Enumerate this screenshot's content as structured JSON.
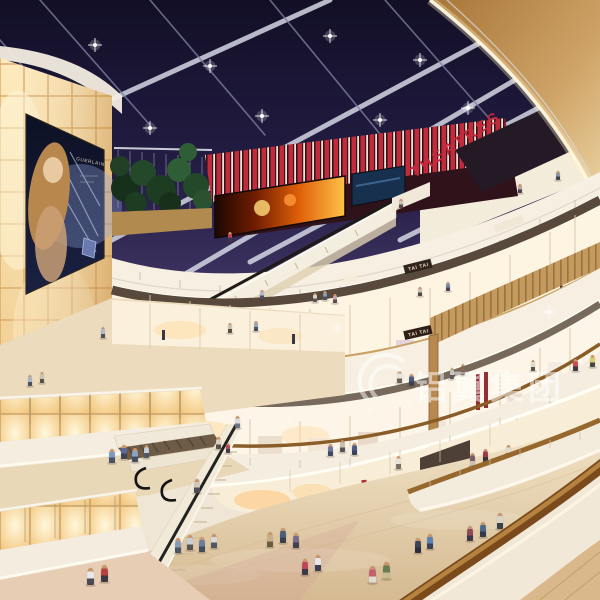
{
  "meta": {
    "title": "Shopping mall atrium interior rendering at night"
  },
  "signs": {
    "theatres": "THEATRES",
    "tai_tai_upper": "TAI TAI",
    "tai_tai_mid": "TAI TAI",
    "ad_brand": "GUERLAIN"
  },
  "watermark": {
    "text": "铝翼集团"
  },
  "palette": {
    "sky": "#1b1733",
    "accent_red": "#c2293a",
    "glow_wall": "#f8dca6",
    "wood": "#c49a5e",
    "fascia": "#f6efe2",
    "floor": "#e7d5b4"
  },
  "figures": [
    [
      315,
      302,
      9,
      "#d8d4ca",
      "#5a5a60",
      1
    ],
    [
      325,
      300,
      9,
      "#8a9ab5",
      "#485066",
      1
    ],
    [
      335,
      303,
      9,
      "#c9a4a8",
      "#564c50",
      1
    ],
    [
      262,
      299,
      9,
      "#b5bcc9",
      "#4c5260",
      1
    ],
    [
      420,
      296,
      9,
      "#c9c4b5",
      "#50484a",
      1
    ],
    [
      448,
      291,
      9,
      "#7a8aa8",
      "#42485a",
      1
    ],
    [
      401,
      208,
      9,
      "#c9c4ba",
      "#50484a",
      1
    ],
    [
      520,
      193,
      9,
      "#b5a8a0",
      "#46424a",
      1
    ],
    [
      558,
      180,
      9,
      "#8a95ad",
      "#3f4550",
      1
    ],
    [
      230,
      241,
      9,
      "#c0485a",
      "#3c3642",
      1
    ],
    [
      103,
      338,
      11,
      "#b0b8c9",
      "#4a5060",
      1
    ],
    [
      230,
      333,
      10,
      "#c9bfae",
      "#565046",
      1
    ],
    [
      256,
      331,
      10,
      "#9aa5b8",
      "#485064",
      1
    ],
    [
      399,
      383,
      12,
      "#e8e5dd",
      "#6a6258",
      1
    ],
    [
      411,
      386,
      12,
      "#4a5a7a",
      "#3a4254",
      1
    ],
    [
      452,
      379,
      11,
      "#c9c4ba",
      "#5a5a64",
      1
    ],
    [
      463,
      375,
      11,
      "#8a6a4a",
      "#4a3f38",
      1
    ],
    [
      533,
      371,
      11,
      "#e0d8c8",
      "#5c5448",
      1
    ],
    [
      575,
      371,
      12,
      "#c94a55",
      "#3e3a44",
      1
    ],
    [
      592,
      367,
      12,
      "#d8cc70",
      "#4a4440",
      1
    ],
    [
      30,
      386,
      11,
      "#aab4c5",
      "#4a5262",
      1
    ],
    [
      42,
      383,
      11,
      "#c9c2b2",
      "#55503f",
      1
    ],
    [
      112,
      463,
      14,
      "#7a9ac9",
      "#4a5468",
      1
    ],
    [
      124,
      459,
      14,
      "#5a6a9a",
      "#3c4458",
      1
    ],
    [
      135,
      462,
      14,
      "#8aa3c4",
      "#465064",
      1
    ],
    [
      146,
      458,
      13,
      "#c8ccd8",
      "#4e5668",
      1
    ],
    [
      218,
      449,
      12,
      "#d8d0c4",
      "#5a5248",
      1
    ],
    [
      228,
      453,
      10,
      "#b5495a",
      "#3c3a46",
      1
    ],
    [
      237,
      428,
      12,
      "#d8d8e0",
      "#6a7488",
      1
    ],
    [
      197,
      493,
      14,
      "#cfc9bd",
      "#4e4e58",
      1
    ],
    [
      398,
      469,
      13,
      "#e8e2d8",
      "#7a7268",
      1
    ],
    [
      330,
      456,
      12,
      "#6a7a9a",
      "#3f4a5e",
      1
    ],
    [
      342,
      452,
      12,
      "#c9c0b0",
      "#555555",
      1
    ],
    [
      354,
      455,
      12,
      "#4a5a80",
      "#38425c",
      1
    ],
    [
      472,
      466,
      13,
      "#7a5a6a",
      "#c9c0b0",
      1
    ],
    [
      485,
      462,
      13,
      "#a03848",
      "#3c3440",
      1
    ],
    [
      508,
      458,
      13,
      "#e0ddd0",
      "#4a5066",
      1
    ],
    [
      520,
      462,
      13,
      "#c9b489",
      "#5a6a50",
      1
    ],
    [
      90,
      585,
      17,
      "#e8e8e8",
      "#4a4a55",
      1
    ],
    [
      104,
      582,
      17,
      "#b5413c",
      "#3a3a44",
      1
    ],
    [
      178,
      553,
      15,
      "#8a9bb5",
      "#4a5568",
      1
    ],
    [
      190,
      550,
      15,
      "#c8cdd6",
      "#555555",
      1
    ],
    [
      202,
      552,
      15,
      "#6a7da0",
      "#444c5c",
      1
    ],
    [
      214,
      548,
      14,
      "#d8d8dc",
      "#505866",
      1
    ],
    [
      270,
      547,
      15,
      "#c9b089",
      "#6a5a40",
      1
    ],
    [
      283,
      543,
      15,
      "#4a5d7a",
      "#3a3f50",
      1
    ],
    [
      296,
      548,
      15,
      "#7a6a8a",
      "#44404e",
      1
    ],
    [
      305,
      575,
      16,
      "#c0455a",
      "#3c3c48",
      1
    ],
    [
      318,
      571,
      16,
      "#e5e5ea",
      "#384058",
      1
    ],
    [
      372,
      583,
      17,
      "#c4606e",
      "#e0ddd0",
      1
    ],
    [
      386,
      579,
      17,
      "#6a7a52",
      "#c9bb92",
      1
    ],
    [
      418,
      553,
      15,
      "#3a4458",
      "#2a2e3c",
      2
    ],
    [
      430,
      549,
      15,
      "#5a81b5",
      "#38425a",
      2
    ],
    [
      470,
      541,
      15,
      "#8a4a5a",
      "#3c3848",
      2
    ],
    [
      483,
      537,
      15,
      "#4a6888",
      "#323a4c",
      2
    ],
    [
      500,
      529,
      16,
      "#d8d4cc",
      "#3a3f4a",
      2
    ],
    [
      520,
      563,
      16,
      "#7a88c0",
      "#3c4460",
      2
    ],
    [
      534,
      558,
      16,
      "#3d4db0",
      "#2c3248",
      2
    ],
    [
      553,
      549,
      14,
      "#b5485a",
      "#3a3648",
      2
    ],
    [
      565,
      546,
      15,
      "#3a3a3a",
      "#2a2a2a",
      2
    ],
    [
      578,
      541,
      15,
      "#6a90b8",
      "#3e4a5e",
      2
    ],
    [
      590,
      544,
      15,
      "#2f89b5",
      "#35404e",
      2
    ]
  ]
}
